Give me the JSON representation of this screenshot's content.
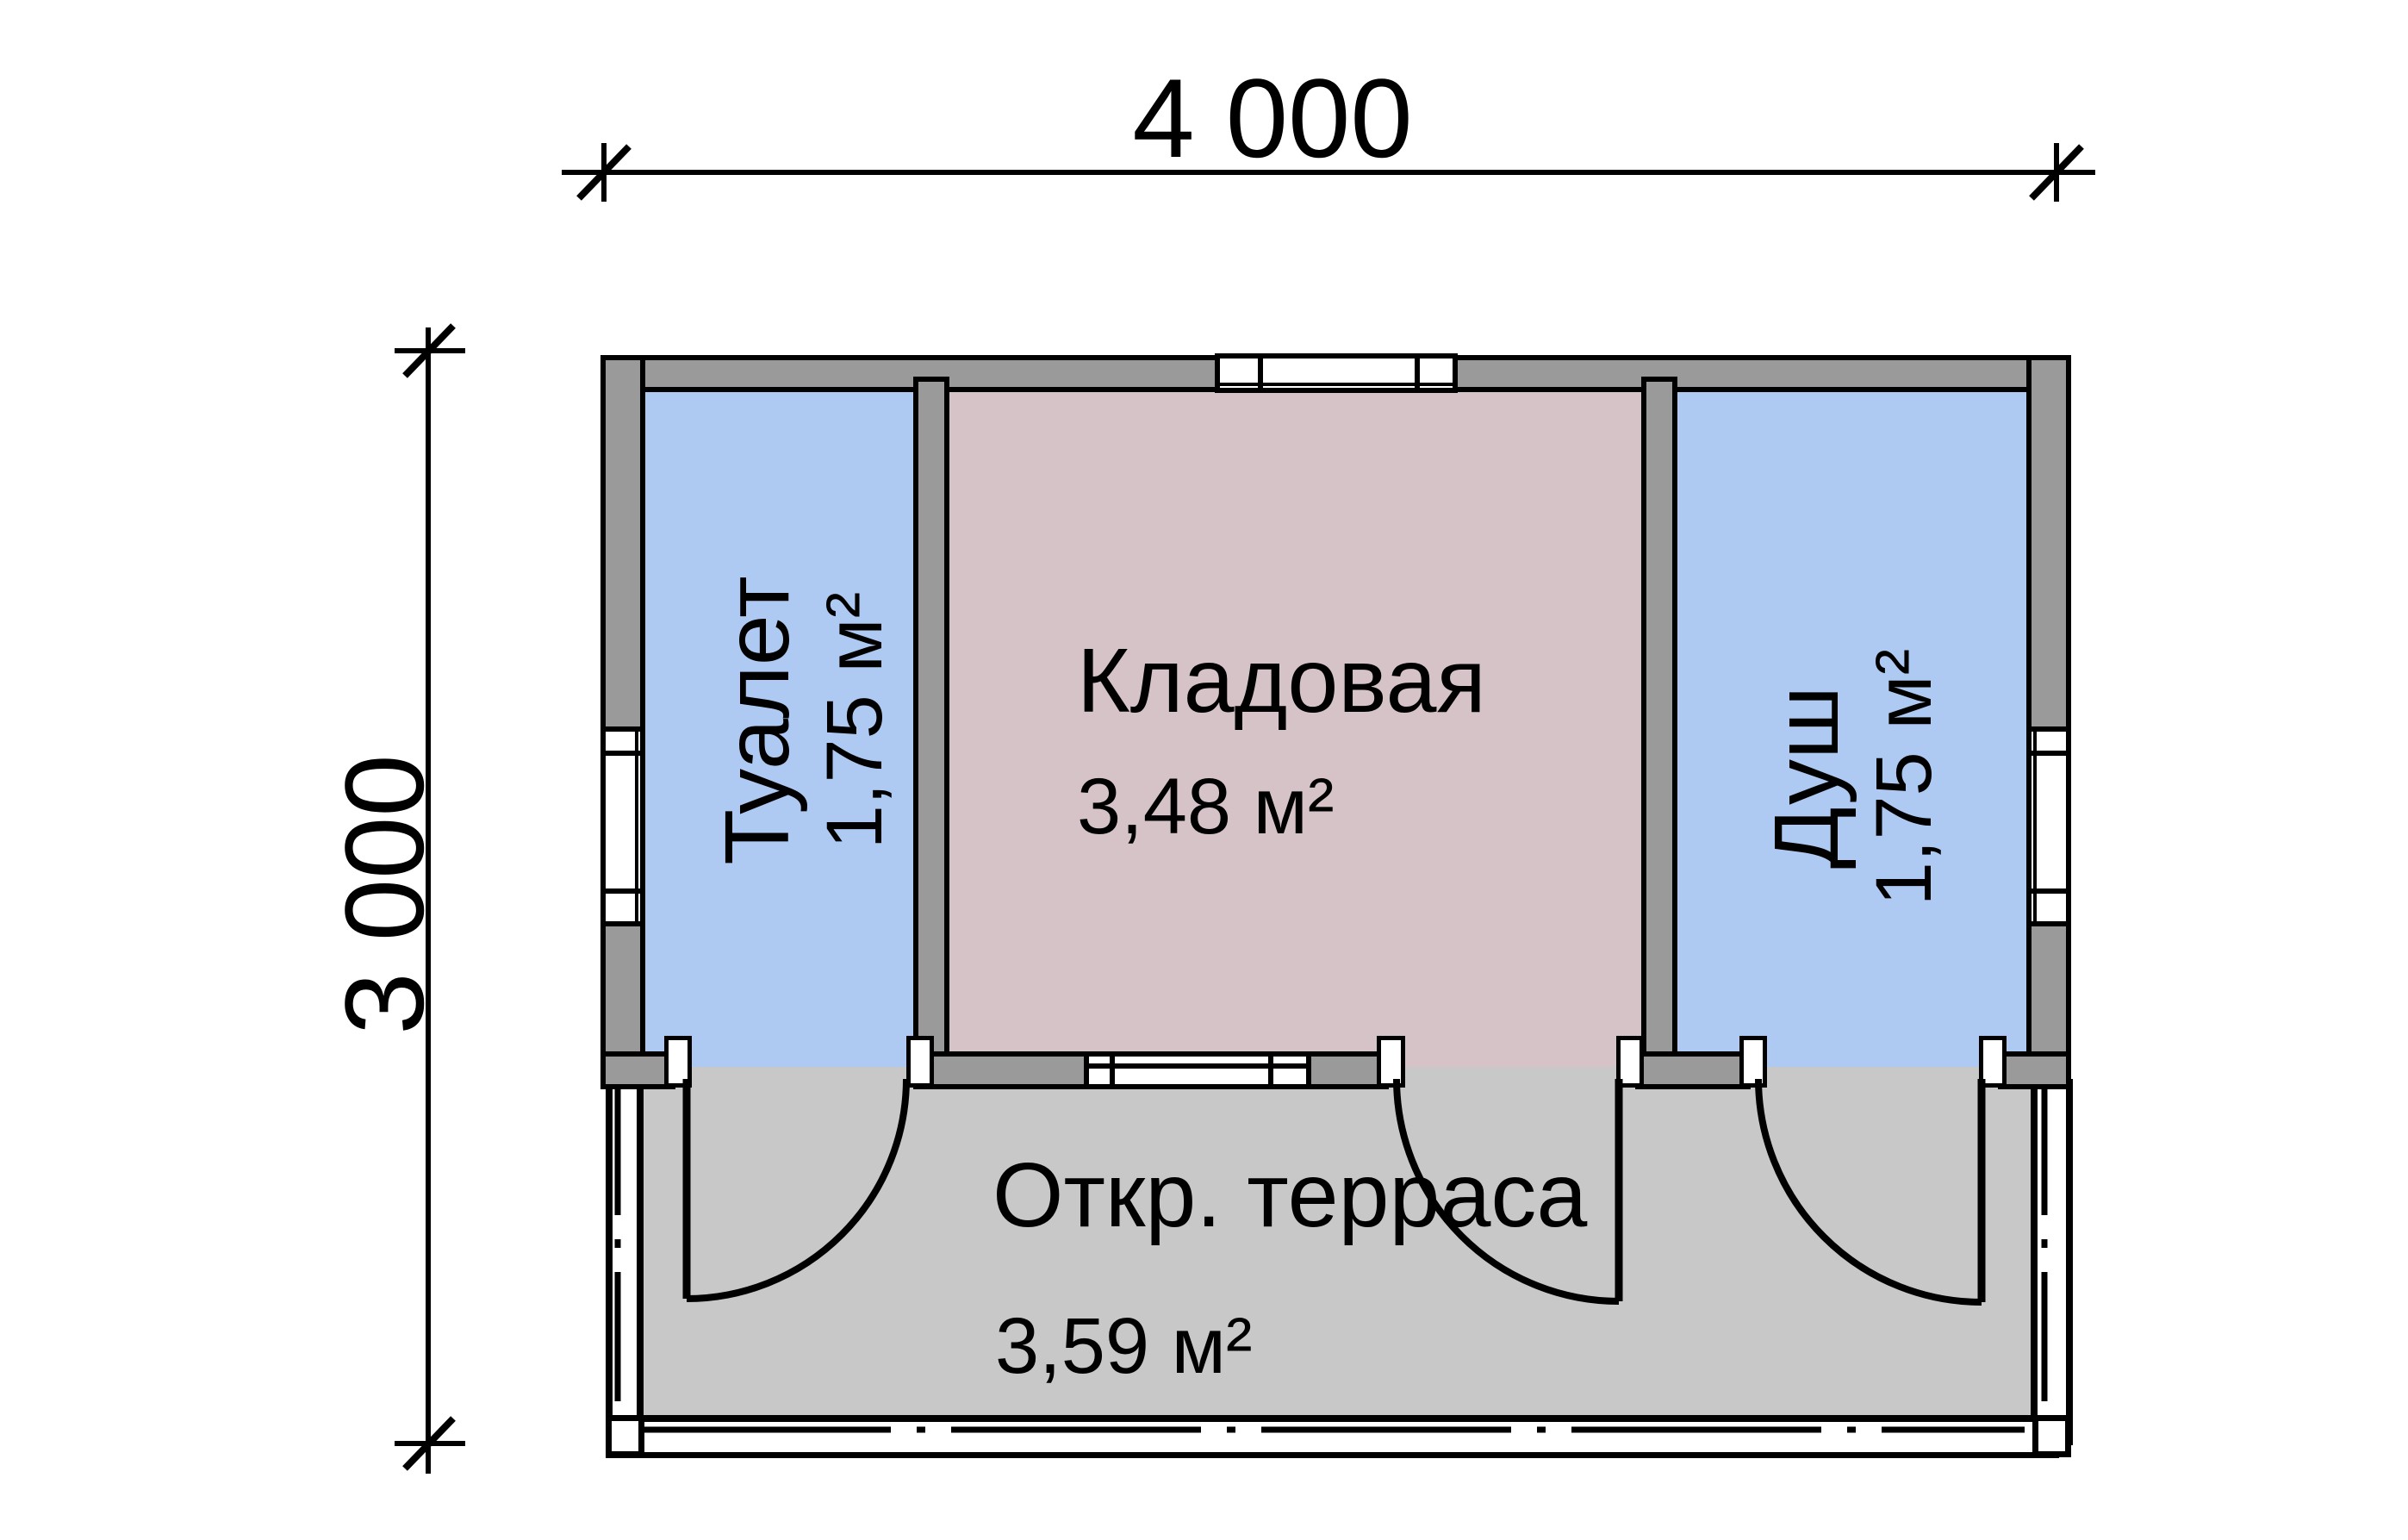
{
  "plan": {
    "dimensions": {
      "width": "4 000",
      "height": "3 000"
    },
    "rooms": [
      {
        "key": "toilet",
        "label": "Туалет",
        "area": "1,75 м²"
      },
      {
        "key": "storage",
        "label": "Кладовая",
        "area": "3,48 м²"
      },
      {
        "key": "shower",
        "label": "Душ",
        "area": "1,75 м²"
      },
      {
        "key": "terrace",
        "label": "Откр. терраса",
        "area": "3,59 м²"
      }
    ],
    "colors": {
      "wet_room_fill": "#aecaf2",
      "storage_fill": "#d6c3c8",
      "terrace_fill": "#c8c8c8",
      "wall_fill": "#9a9a9a",
      "line": "#000000"
    }
  }
}
